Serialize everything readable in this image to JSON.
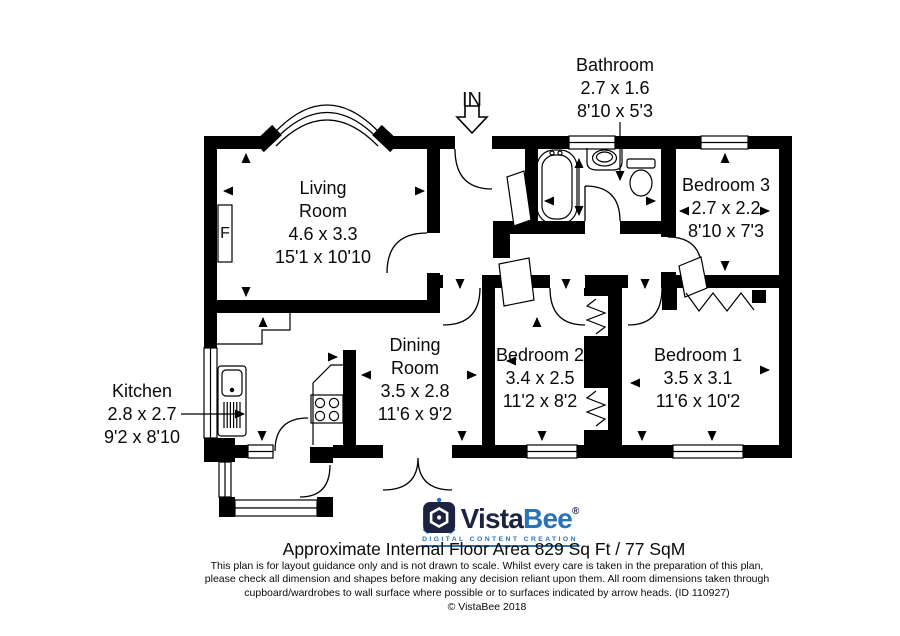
{
  "rooms": {
    "living": {
      "lines": [
        "Living",
        "Room",
        "4.6 x 3.3",
        "15'1 x 10'10"
      ]
    },
    "bathroom": {
      "lines": [
        "Bathroom",
        "2.7 x 1.6",
        "8'10 x 5'3"
      ]
    },
    "bedroom3": {
      "lines": [
        "Bedroom 3",
        "2.7 x 2.2",
        "8'10 x 7'3"
      ]
    },
    "dining": {
      "lines": [
        "Dining",
        "Room",
        "3.5 x 2.8",
        "11'6 x 9'2"
      ]
    },
    "bedroom2": {
      "lines": [
        "Bedroom 2",
        "3.4 x 2.5",
        "11'2 x 8'2"
      ]
    },
    "bedroom1": {
      "lines": [
        "Bedroom 1",
        "3.5 x 3.1",
        "11'6 x 10'2"
      ]
    },
    "kitchen": {
      "lines": [
        "Kitchen",
        "2.8 x 2.7",
        "9'2 x 8'10"
      ]
    }
  },
  "annotations": {
    "entrance": "IN",
    "fireplace": "F"
  },
  "footer": {
    "brand_vista": "Vista",
    "brand_bee": "Bee",
    "registered": "®",
    "tagline": "DIGITAL CONTENT CREATION",
    "area_text": "Approximate Internal Floor Area 829 Sq Ft / 77 SqM",
    "disclaimer_lines": [
      "This plan is for layout guidance only and is not drawn to scale. Whilst every care is taken in the preparation of this plan,",
      "please check all dimension and shapes before making any decision reliant upon them. All room dimensions taken through",
      "cupboard/wardrobes to wall surface where possible or to surfaces indicated by arrow heads. (ID 110927)"
    ],
    "copyright": "© VistaBee 2018"
  },
  "colors": {
    "wall": "#000000",
    "brand_navy": "#1c2340",
    "brand_blue": "#2a73b8"
  }
}
